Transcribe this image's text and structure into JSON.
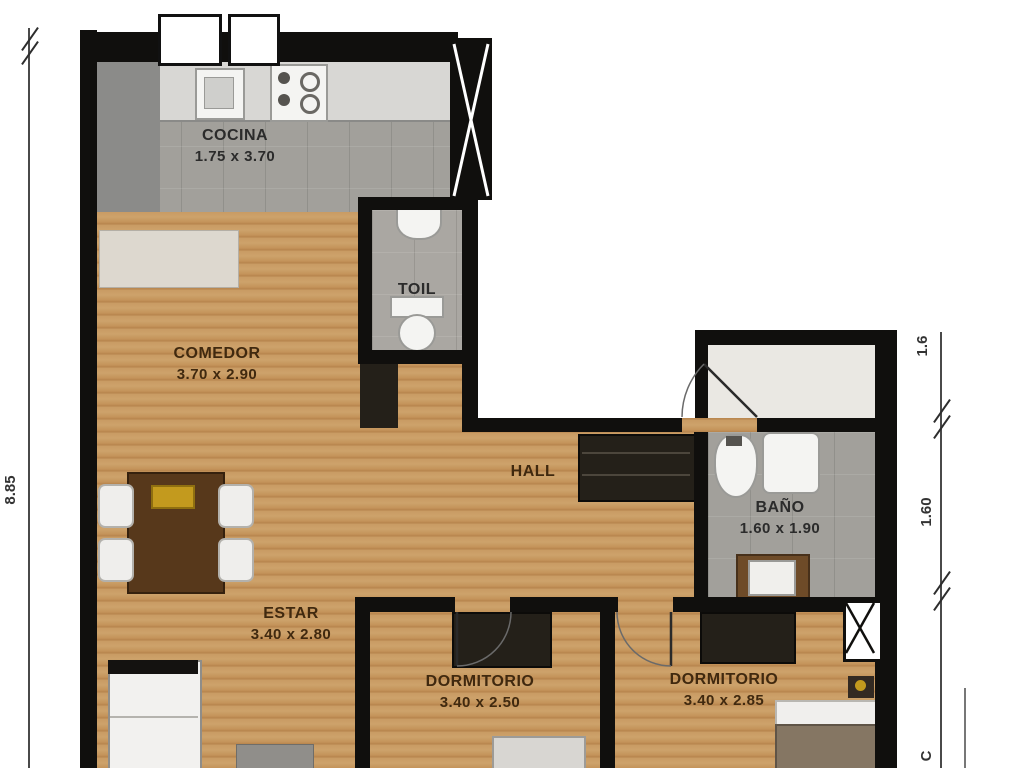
{
  "plan": {
    "title": "apartment-floor-plan",
    "rooms": [
      {
        "id": "cocina",
        "name": "COCINA",
        "dims": "1.75 x 3.70"
      },
      {
        "id": "toil",
        "name": "TOIL",
        "dims": ""
      },
      {
        "id": "comedor",
        "name": "COMEDOR",
        "dims": "3.70 x 2.90"
      },
      {
        "id": "hall",
        "name": "HALL",
        "dims": ""
      },
      {
        "id": "bano",
        "name": "BAÑO",
        "dims": "1.60 x 1.90"
      },
      {
        "id": "estar",
        "name": "ESTAR",
        "dims": "3.40 x 2.80"
      },
      {
        "id": "dormitorio1",
        "name": "DORMITORIO",
        "dims": "3.40 x 2.50"
      },
      {
        "id": "dormitorio2",
        "name": "DORMITORIO",
        "dims": "3.40 x 2.85"
      }
    ],
    "dimensions": {
      "left_total": "8.85",
      "right_top": "1.6",
      "right_middle": "1.60",
      "right_bottom_partial": "C"
    },
    "fixtures": [
      "kitchen-sink",
      "stove",
      "refrigerator-cabinet",
      "kitchen-counter",
      "toilet",
      "toil-sink",
      "bidet",
      "bathroom-toilet",
      "vanity-sink",
      "dining-table",
      "chair",
      "gold-tray",
      "hall-wardrobe",
      "bedroom-wardrobe",
      "bed",
      "night-lamp",
      "white-cabinet",
      "pouf",
      "elevator-shaft",
      "air-duct",
      "door-swing",
      "window"
    ],
    "colors": {
      "wall": "#100f0d",
      "wood_floor": "#c89b63",
      "tile_floor": "#a2a09b",
      "gold_accent": "#c39a1e",
      "blanket": "#857663"
    }
  }
}
